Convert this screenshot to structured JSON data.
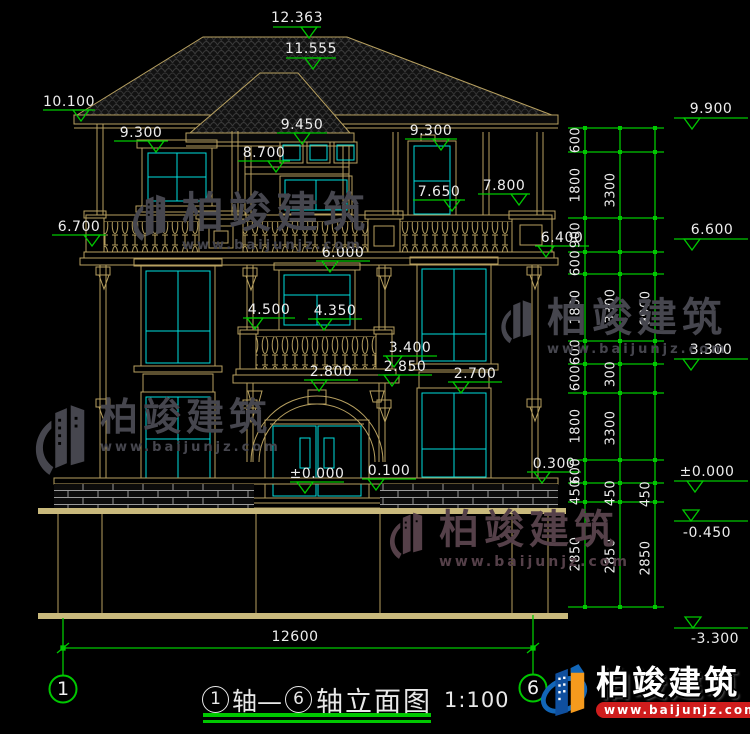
{
  "page": {
    "background": "#000000"
  },
  "title_block": {
    "axis_no_start": "1",
    "axis_word_start": "轴—",
    "axis_no_end": "6",
    "drawing_name": "轴立面图",
    "scale": "1:100"
  },
  "axis_bubbles": {
    "left": "1",
    "right": "6"
  },
  "elevation_labels": [
    {
      "t": "12.363",
      "x": 297,
      "y": 18
    },
    {
      "t": "11.555",
      "x": 311,
      "y": 49
    },
    {
      "t": "10.100",
      "x": 69,
      "y": 102
    },
    {
      "t": "9.300",
      "x": 141,
      "y": 133
    },
    {
      "t": "9.450",
      "x": 302,
      "y": 125
    },
    {
      "t": "8.700",
      "x": 264,
      "y": 153
    },
    {
      "t": "9.300",
      "x": 431,
      "y": 131
    },
    {
      "t": "7.650",
      "x": 439,
      "y": 192
    },
    {
      "t": "7.800",
      "x": 504,
      "y": 186
    },
    {
      "t": "6.700",
      "x": 79,
      "y": 227
    },
    {
      "t": "6.400",
      "x": 562,
      "y": 238
    },
    {
      "t": "6.000",
      "x": 343,
      "y": 253
    },
    {
      "t": "4.500",
      "x": 269,
      "y": 310
    },
    {
      "t": "4.350",
      "x": 335,
      "y": 311
    },
    {
      "t": "3.400",
      "x": 410,
      "y": 348
    },
    {
      "t": "2.850",
      "x": 405,
      "y": 367
    },
    {
      "t": "2.800",
      "x": 331,
      "y": 372
    },
    {
      "t": "2.700",
      "x": 475,
      "y": 374
    },
    {
      "t": "±0.000",
      "x": 317,
      "y": 474
    },
    {
      "t": "0.100",
      "x": 389,
      "y": 471
    },
    {
      "t": "0.300",
      "x": 554,
      "y": 464
    },
    {
      "t": "9.900",
      "x": 711,
      "y": 109
    },
    {
      "t": "6.600",
      "x": 712,
      "y": 230
    },
    {
      "t": "3.300",
      "x": 711,
      "y": 350
    },
    {
      "t": "±0.000",
      "x": 707,
      "y": 472
    },
    {
      "t": "-0.450",
      "x": 707,
      "y": 533
    },
    {
      "t": "-3.300",
      "x": 715,
      "y": 639
    },
    {
      "t": "12600",
      "x": 295,
      "y": 637
    }
  ],
  "chain_labels": [
    {
      "t": "600",
      "x": 576,
      "y": 140
    },
    {
      "t": "1800",
      "x": 576,
      "y": 185
    },
    {
      "t": "900",
      "x": 576,
      "y": 235
    },
    {
      "t": "600",
      "x": 576,
      "y": 263
    },
    {
      "t": "1800",
      "x": 576,
      "y": 307
    },
    {
      "t": "600",
      "x": 576,
      "y": 352
    },
    {
      "t": "600",
      "x": 576,
      "y": 378
    },
    {
      "t": "1800",
      "x": 576,
      "y": 426
    },
    {
      "t": "600",
      "x": 576,
      "y": 471
    },
    {
      "t": "450",
      "x": 576,
      "y": 492
    },
    {
      "t": "2850",
      "x": 576,
      "y": 554
    },
    {
      "t": "3300",
      "x": 611,
      "y": 190
    },
    {
      "t": "3300",
      "x": 611,
      "y": 306
    },
    {
      "t": "300",
      "x": 611,
      "y": 374
    },
    {
      "t": "3300",
      "x": 611,
      "y": 428
    },
    {
      "t": "450",
      "x": 611,
      "y": 493
    },
    {
      "t": "2850",
      "x": 611,
      "y": 556
    },
    {
      "t": "9900",
      "x": 646,
      "y": 308
    },
    {
      "t": "450",
      "x": 646,
      "y": 494
    },
    {
      "t": "2850",
      "x": 646,
      "y": 558
    }
  ],
  "watermarks": {
    "brand_cn": "柏竣建筑",
    "brand_url": "www.baijunjz.com"
  },
  "brand_footer": {
    "name": "柏竣建筑",
    "url": "www.baijunjz.com"
  },
  "colors": {
    "line_tan": "#b7a060",
    "ground_tan": "#c9b97c",
    "window_cyan": "#00dede",
    "dim_green": "#00c800",
    "text_white": "#ededed",
    "watermark_grey": "#46464e",
    "watermark_maroon": "#554049",
    "brand_red": "#cf1d1d",
    "brand_blue": "#1266b8",
    "brand_dark_blue": "#0f4f9e",
    "brand_orange": "#f59a1d"
  }
}
